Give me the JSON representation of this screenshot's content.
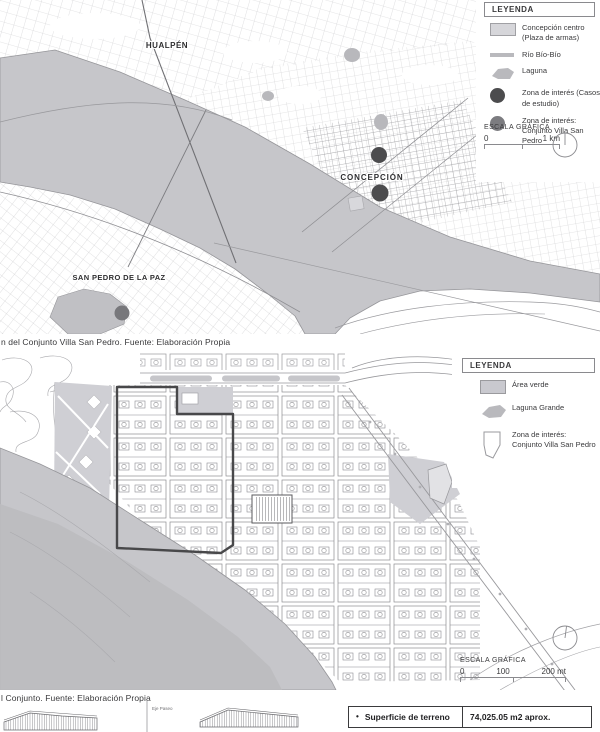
{
  "colors": {
    "water": "#c6c6ca",
    "water_deep": "#bbbbbf",
    "area_verde": "#cfcfd4",
    "legend_swatch_light": "#d6d6da",
    "street": "#98989c",
    "dot_dark": "#4c4c4e",
    "dot_medium": "#7c7c80",
    "zone_outline": "#48484a",
    "text": "#3a3a3c"
  },
  "map_overview": {
    "city_labels": [
      {
        "name": "HUALPÉN"
      },
      {
        "name": "CONCEPCIÓN"
      },
      {
        "name": "SAN PEDRO DE LA PAZ"
      }
    ],
    "legend": {
      "title": "LEYENDA",
      "items": [
        {
          "id": "concepcion-centro",
          "label": "Concepción centro (Plaza de armas)"
        },
        {
          "id": "rio-bio-bio",
          "label": "Río Bío-Bío"
        },
        {
          "id": "laguna",
          "label": "Laguna"
        },
        {
          "id": "zona-interes-estudio",
          "label": "Zona de interés (Casos de estudio)"
        },
        {
          "id": "zona-interes-villa",
          "label": "Zona de interés: Conjunto Villa San Pedro"
        }
      ]
    },
    "scale": {
      "title": "ESCALA GRÁFICA",
      "tick_start": "0",
      "tick_end": "1 km"
    }
  },
  "caption_overview": "n del Conjunto Villa San Pedro. Fuente: Elaboración Propia",
  "map_detail": {
    "legend": {
      "title": "LEYENDA",
      "items": [
        {
          "id": "area-verde",
          "label": "Área verde"
        },
        {
          "id": "laguna-grande",
          "label": "Laguna Grande"
        },
        {
          "id": "zona-interes-villa",
          "label": "Zona de interés: Conjunto Villa San Pedro"
        }
      ]
    },
    "scale": {
      "title": "ESCALA GRÁFICA",
      "tick_start": "0",
      "tick_mid": "100",
      "tick_end": "200 mt"
    }
  },
  "caption_detail": "l Conjunto. Fuente: Elaboración Propia",
  "footer": {
    "axis_label": "Eje Paseo",
    "terrain_table": {
      "bullet": "•",
      "label": "Superficie de terreno",
      "value": "74,025.05 m2 aprox."
    }
  }
}
